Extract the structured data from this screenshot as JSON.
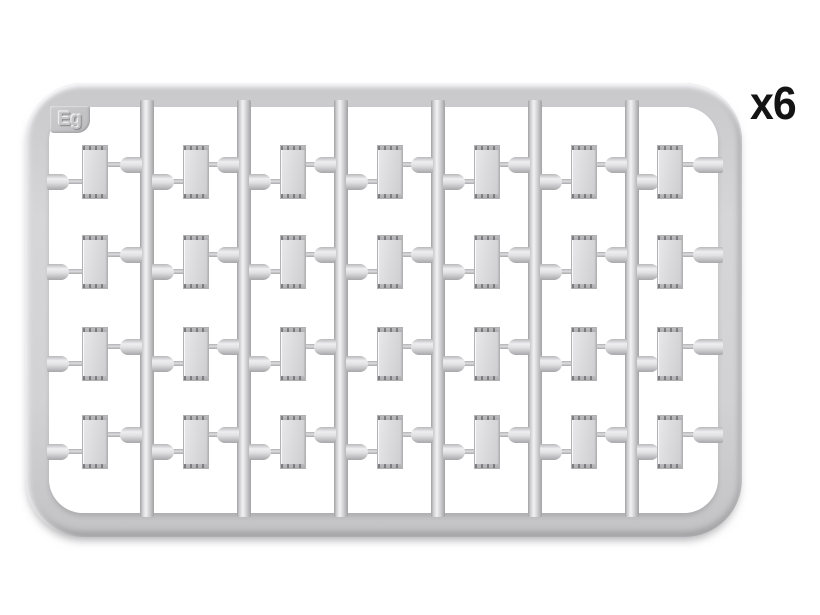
{
  "product_image": {
    "sprue_code_label": "Eg",
    "quantity_label": "x6",
    "grid": {
      "columns": 7,
      "rows": 4,
      "total_parts": 28
    }
  },
  "colors": {
    "background": "#ffffff",
    "plastic_light": "#f2f2f4",
    "plastic_mid": "#d6d6d8",
    "plastic_dark": "#a5a5a7",
    "quantity_text": "#141414"
  }
}
